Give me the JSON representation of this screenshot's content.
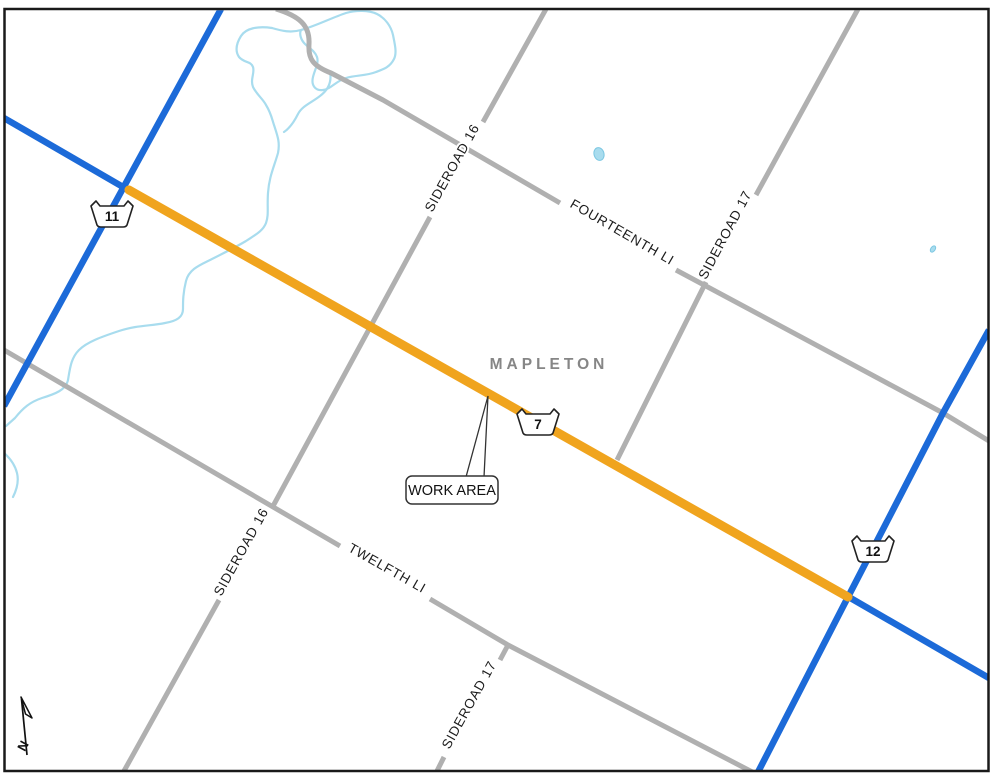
{
  "map": {
    "municipality_label": "MAPLETON",
    "work_area": {
      "callout_label": "WORK AREA"
    },
    "north_arrow_label": "N",
    "road_labels": {
      "sideroad_16_north": "SIDEROAD 16",
      "sideroad_16_south": "SIDEROAD 16",
      "sideroad_17_north": "SIDEROAD 17",
      "sideroad_17_south": "SIDEROAD 17",
      "fourteenth_line": "FOURTEENTH LI",
      "twelfth_line": "TWELFTH LI"
    },
    "highway_markers": {
      "west": "11",
      "central": "7",
      "east": "12"
    },
    "colors": {
      "provincial_road_blue": "#1C6AD8",
      "work_area_orange": "#F0A41E",
      "local_road_gray": "#B0B0B0",
      "stream_blue": "#A8DCEE",
      "pond_outline_blue": "#7CC7E2",
      "municipality_text_gray": "#868686",
      "frame_black": "#1a1a1a"
    }
  }
}
